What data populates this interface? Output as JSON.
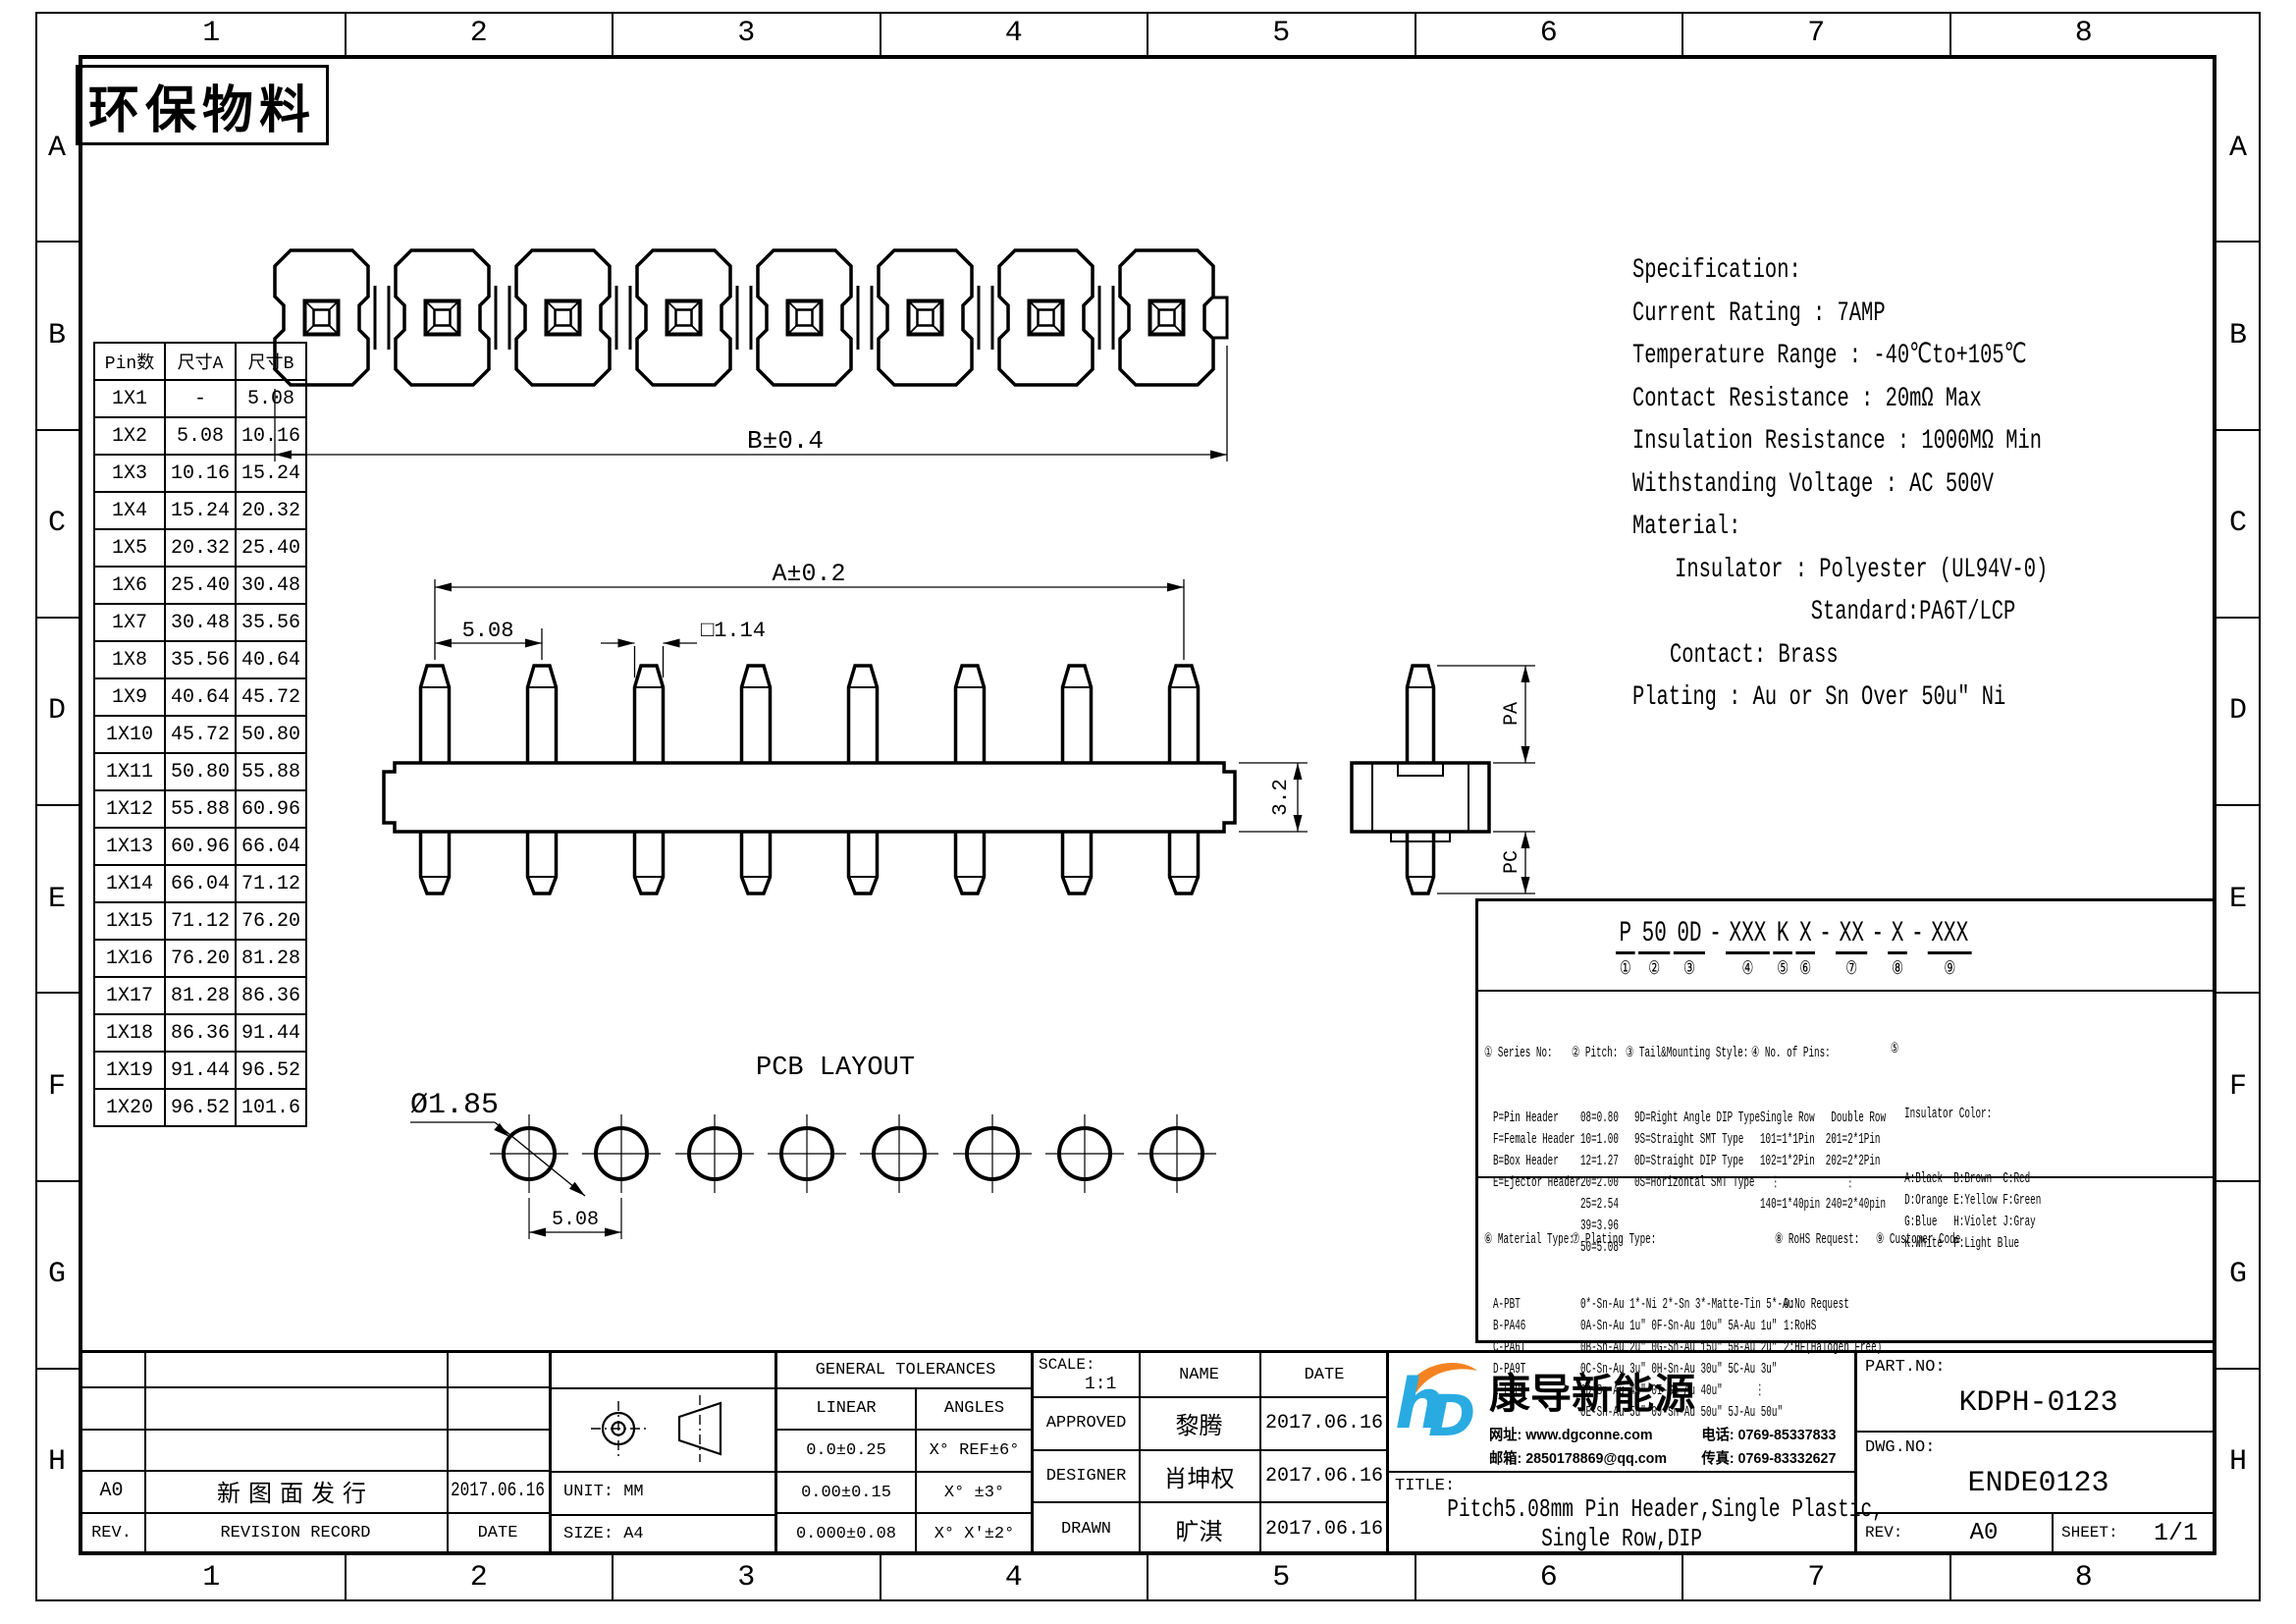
{
  "sheet": {
    "stamp": "环保物料",
    "grid_columns": [
      "1",
      "2",
      "3",
      "4",
      "5",
      "6",
      "7",
      "8"
    ],
    "grid_rows": [
      "A",
      "B",
      "C",
      "D",
      "E",
      "F",
      "G",
      "H"
    ]
  },
  "pin_table": {
    "headers": [
      "Pin数",
      "尺寸A",
      "尺寸B"
    ],
    "rows": [
      [
        "1X1",
        "-",
        "5.08"
      ],
      [
        "1X2",
        "5.08",
        "10.16"
      ],
      [
        "1X3",
        "10.16",
        "15.24"
      ],
      [
        "1X4",
        "15.24",
        "20.32"
      ],
      [
        "1X5",
        "20.32",
        "25.40"
      ],
      [
        "1X6",
        "25.40",
        "30.48"
      ],
      [
        "1X7",
        "30.48",
        "35.56"
      ],
      [
        "1X8",
        "35.56",
        "40.64"
      ],
      [
        "1X9",
        "40.64",
        "45.72"
      ],
      [
        "1X10",
        "45.72",
        "50.80"
      ],
      [
        "1X11",
        "50.80",
        "55.88"
      ],
      [
        "1X12",
        "55.88",
        "60.96"
      ],
      [
        "1X13",
        "60.96",
        "66.04"
      ],
      [
        "1X14",
        "66.04",
        "71.12"
      ],
      [
        "1X15",
        "71.12",
        "76.20"
      ],
      [
        "1X16",
        "76.20",
        "81.28"
      ],
      [
        "1X17",
        "81.28",
        "86.36"
      ],
      [
        "1X18",
        "86.36",
        "91.44"
      ],
      [
        "1X19",
        "91.44",
        "96.52"
      ],
      [
        "1X20",
        "96.52",
        "101.6"
      ]
    ]
  },
  "specification": {
    "lines": [
      "Specification:",
      "Current Rating : 7AMP",
      "Temperature Range : -40℃to+105℃",
      "Contact Resistance : 20mΩ Max",
      "Insulation Resistance : 1000MΩ Min",
      "Withstanding Voltage : AC 500V",
      "Material:",
      "Insulator : Polyester (UL94V-0)",
      "Standard:PA6T/LCP",
      "Contact: Brass",
      "Plating : Au or Sn Over 50u″ Ni"
    ]
  },
  "dimensions": {
    "top_view_width": "B±0.4",
    "overall": "A±0.2",
    "pitch": "5.08",
    "pin_square": "□1.14",
    "body_height": "3.2",
    "pin_length_top": "PA",
    "pin_length_bottom": "PC",
    "pcb_hole_dia": "Ø1.85",
    "pcb_pitch": "5.08",
    "pcb_view_label": "PCB LAYOUT"
  },
  "part_code": {
    "segments": [
      {
        "text": "P",
        "mark": "①"
      },
      {
        "text": "50",
        "mark": "②"
      },
      {
        "text": "0D",
        "mark": "③"
      },
      {
        "text": "-",
        "mark": ""
      },
      {
        "text": "XXX",
        "mark": "④"
      },
      {
        "text": "K",
        "mark": "⑤"
      },
      {
        "text": "X",
        "mark": "⑥"
      },
      {
        "text": "-",
        "mark": ""
      },
      {
        "text": "XX",
        "mark": "⑦"
      },
      {
        "text": "-",
        "mark": ""
      },
      {
        "text": "X",
        "mark": "⑧"
      },
      {
        "text": "-",
        "mark": ""
      },
      {
        "text": "XXX",
        "mark": "⑨"
      }
    ],
    "series": {
      "title": "① Series No:",
      "items": [
        "P=Pin Header",
        "F=Female Header",
        "B=Box Header",
        "E=Ejector Header"
      ]
    },
    "pitch": {
      "title": "② Pitch:",
      "items": [
        "08=0.80",
        "10=1.00",
        "12=1.27",
        "20=2.00",
        "25=2.54",
        "39=3.96",
        "50=5.08"
      ]
    },
    "tail": {
      "title": "③ Tail&Mounting Style:",
      "items": [
        "9D=Right Angle DIP Type",
        "9S=Straight SMT Type",
        "0D=Straight DIP Type",
        "0S=Horizontal SMT Type"
      ]
    },
    "pins": {
      "title": "④ No. of Pins:",
      "items": [
        "Single Row   Double Row",
        "101=1*1Pin  201=2*1Pin",
        "102=1*2Pin  202=2*2Pin",
        "  ⋮            ⋮",
        "140=1*40pin 240=2*40pin"
      ]
    },
    "color": {
      "mark": "⑤",
      "title": "Insulator Color:",
      "items": [
        "A:Black  B:Brown  C:Red",
        "D:Orange E:Yellow F:Green",
        "G:Blue   H:Violet J:Gray",
        "K:White  P:Light Blue"
      ]
    },
    "material": {
      "title": "⑥ Material Type:",
      "items": [
        "A-PBT",
        "B-PA46",
        "C-PA6T",
        "D-PA9T",
        "E-LCP"
      ]
    },
    "plating": {
      "title": "⑦ Plating Type:",
      "items": [
        "0*-Sn-Au 1*-Ni 2*-Sn 3*-Matte-Tin 5*-Au",
        "0A-Sn-Au 1u″ 0F-Sn-Au 10u″ 5A-Au 1u″",
        "0B-Sn-Au 2u″ 0G-Sn-Au 15u″ 5B-Au 2u″",
        "0C-Sn-Au 3u″ 0H-Sn-Au 30u″ 5C-Au 3u″",
        "0D-Sn-Au 4u″ 0I-Sn-Au 40u″      ⋮",
        "0E-Sn-Au 5u″ 0J-Sn-Au 50u″ 5J-Au 50u″"
      ]
    },
    "rohs": {
      "title": "⑧ RoHS Request:",
      "items": [
        "0:No Request",
        "1:RoHS",
        "2:HF(Halogen Free)"
      ]
    },
    "customer": {
      "title": "⑨ Customer Code"
    }
  },
  "title_block": {
    "revision": {
      "headers": [
        "REV.",
        "REVISION RECORD",
        "DATE"
      ],
      "rows": [
        [
          "A0",
          "新图面发行",
          "2017.06.16"
        ]
      ]
    },
    "unit": "UNIT: MM",
    "size": "SIZE: A4",
    "tolerances": {
      "title": "GENERAL TOLERANCES",
      "columns": [
        "LINEAR",
        "ANGLES"
      ],
      "rows": [
        [
          "0.0±0.25",
          "X° REF±6°"
        ],
        [
          "0.00±0.15",
          "X° ±3°"
        ],
        [
          "0.000±0.08",
          "X° X'±2°"
        ]
      ]
    },
    "scale_label": "SCALE:",
    "scale_value": "1:1",
    "name_header": "NAME",
    "date_header": "DATE",
    "signoff": [
      {
        "role": "APPROVED",
        "name": "黎腾",
        "date": "2017.06.16"
      },
      {
        "role": "DESIGNER",
        "name": "肖坤权",
        "date": "2017.06.16"
      },
      {
        "role": "DRAWN",
        "name": "旷淇",
        "date": "2017.06.16"
      }
    ],
    "company": {
      "logo_text": "hD",
      "name": "康导新能源",
      "website": "网址: www.dgconne.com",
      "phone": "电话: 0769-85337833",
      "email": "邮箱: 2850178869@qq.com",
      "fax": "传真: 0769-83332627",
      "logo_blue": "#29abe2",
      "logo_orange": "#f58220"
    },
    "title_label": "TITLE:",
    "title_line1": "Pitch5.08mm Pin Header,Single Plastic,",
    "title_line2": "Single Row,DIP",
    "part_no_label": "PART.NO:",
    "part_no": "KDPH-0123",
    "dwg_no_label": "DWG.NO:",
    "dwg_no": "ENDE0123",
    "rev_label": "REV:",
    "rev": "A0",
    "sheet_label": "SHEET:",
    "sheet": "1/1"
  }
}
